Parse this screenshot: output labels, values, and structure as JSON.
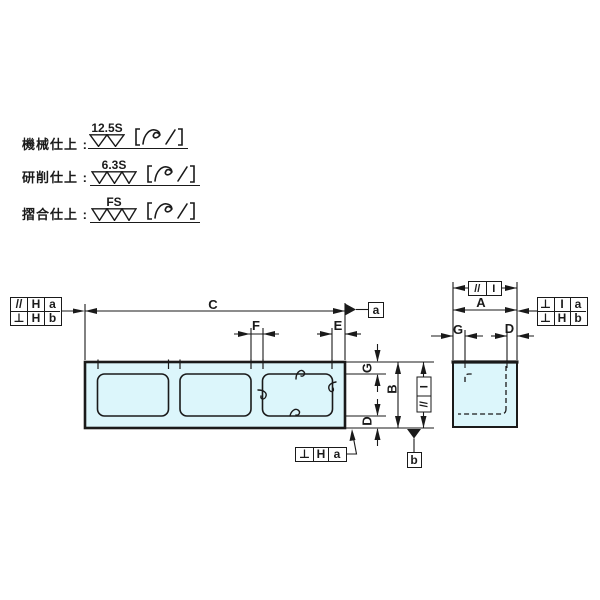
{
  "title": "precision-block-drawing",
  "colors": {
    "line": "#1a1a1a",
    "fill": "#dcf6fb",
    "background": "#ffffff"
  },
  "finish_notes": [
    {
      "label": "機械仕上 :",
      "grade": "12.5S",
      "triangles": 2,
      "suffix_symbol": "〔∿/〕"
    },
    {
      "label": "研削仕上 :",
      "grade": "6.3S",
      "triangles": 3,
      "suffix_symbol": "〔∿/〕"
    },
    {
      "label": "摺合仕上 :",
      "grade": "FS",
      "triangles": 3,
      "suffix_symbol": "〔∿/〕"
    }
  ],
  "dimension_labels": {
    "C": "C",
    "F": "F",
    "E": "E",
    "A": "A",
    "B": "B",
    "G": "G",
    "D": "D"
  },
  "tolerance_frames": {
    "front_left_row1": {
      "symbol": "//",
      "datum": "H",
      "ref": "a"
    },
    "front_left_row2": {
      "symbol": "⊥",
      "datum": "H",
      "ref": "b"
    },
    "front_bottom": {
      "symbol": "⊥",
      "datum": "H",
      "ref": "a"
    },
    "front_vertical": {
      "symbol": "//",
      "datum": "I"
    },
    "side_top": {
      "symbol": "//",
      "datum": "I"
    },
    "side_right_row1": {
      "symbol": "⊥",
      "datum": "I",
      "ref": "a"
    },
    "side_right_row2": {
      "symbol": "⊥",
      "datum": "H",
      "ref": "b"
    }
  },
  "datum_labels": {
    "a": "a",
    "b": "b"
  }
}
